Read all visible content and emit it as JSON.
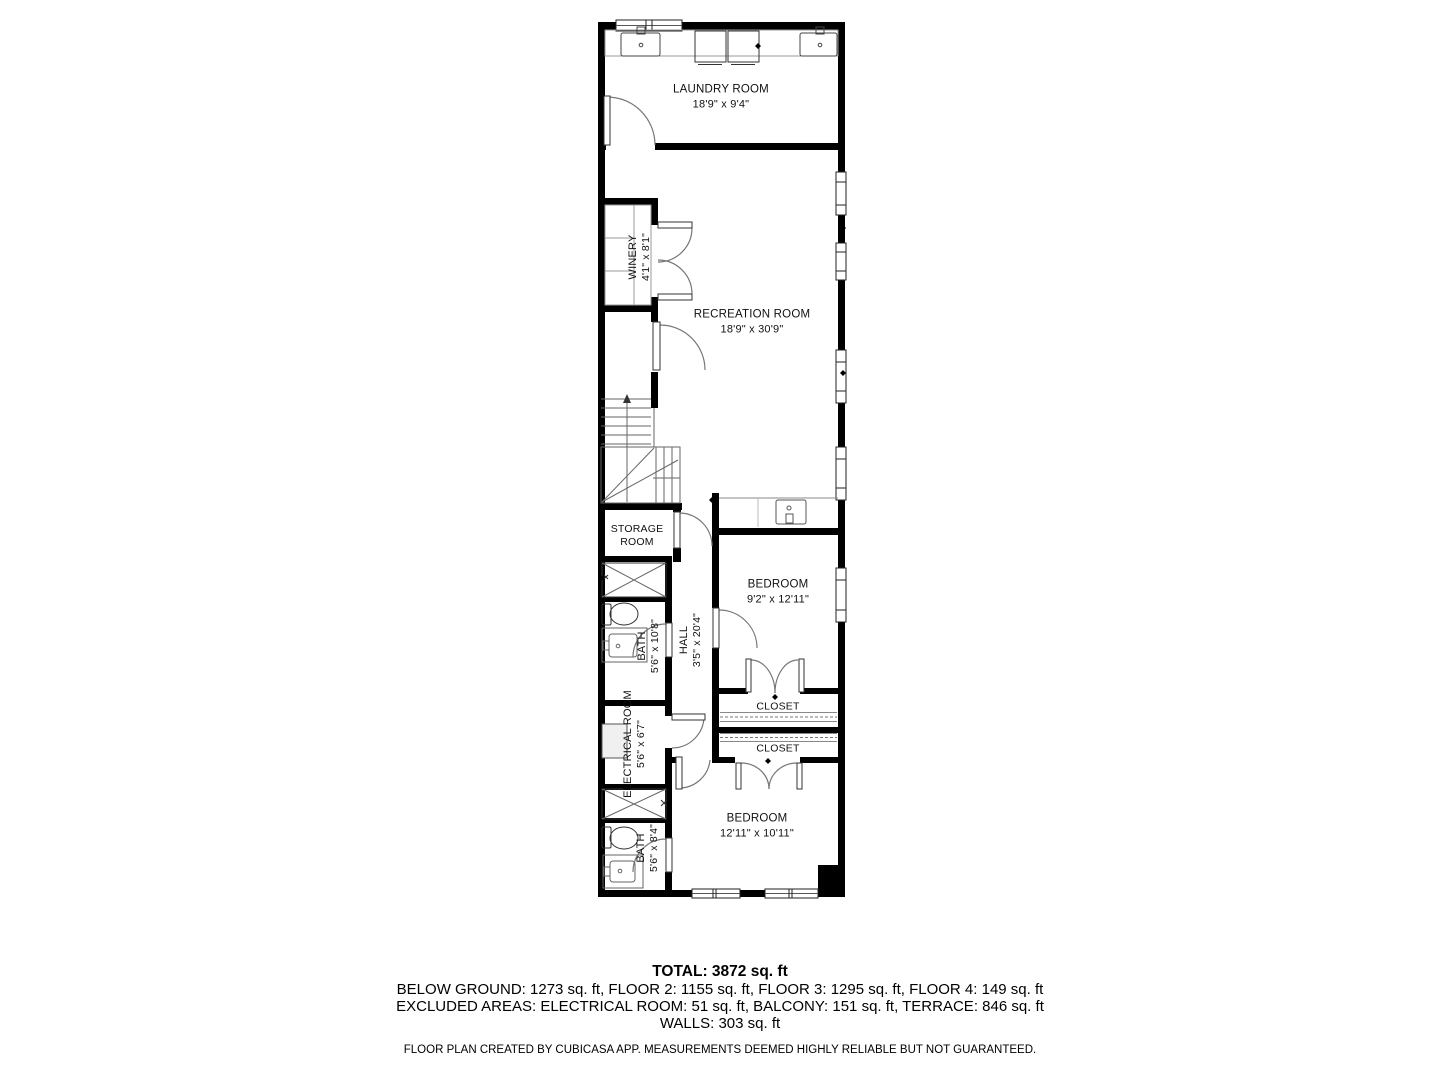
{
  "floor_plan": {
    "rooms": {
      "laundry": {
        "name": "LAUNDRY ROOM",
        "dims": "18'9\" x 9'4\""
      },
      "winery": {
        "name": "WINERY",
        "dims": "4'1\" x 8'1\""
      },
      "recreation": {
        "name": "RECREATION ROOM",
        "dims": "18'9\" x 30'9\""
      },
      "storage": {
        "name_line1": "STORAGE",
        "name_line2": "ROOM"
      },
      "bath_upper": {
        "name": "BATH",
        "dims": "5'6\" x 10'8\""
      },
      "hall": {
        "name": "HALL",
        "dims": "3'5\" x 20'4\""
      },
      "bedroom_upper": {
        "name": "BEDROOM",
        "dims": "9'2\" x 12'11\""
      },
      "closet_upper": {
        "name": "CLOSET"
      },
      "closet_lower": {
        "name": "CLOSET"
      },
      "electrical": {
        "name": "ELECTRICAL ROOM",
        "dims": "5'6\" x 6'7\""
      },
      "bath_lower": {
        "name": "BATH",
        "dims": "5'6\" x 8'4\""
      },
      "bedroom_lower": {
        "name": "BEDROOM",
        "dims": "12'11\" x 10'11\""
      }
    },
    "summary": {
      "total": "TOTAL: 3872 sq. ft",
      "floors": "BELOW GROUND: 1273 sq. ft, FLOOR 2: 1155 sq. ft, FLOOR 3: 1295 sq. ft, FLOOR 4: 149 sq. ft",
      "excluded": "EXCLUDED AREAS: ELECTRICAL ROOM: 51 sq. ft, BALCONY: 151 sq. ft, TERRACE: 846 sq. ft",
      "walls": "WALLS: 303 sq. ft",
      "disclaimer": "FLOOR PLAN CREATED BY CUBICASA APP. MEASUREMENTS DEEMED HIGHLY RELIABLE BUT NOT GUARANTEED."
    },
    "colors": {
      "wall": "#000000",
      "fixture_line": "#555555",
      "light_line": "#999999",
      "text": "#111111"
    }
  }
}
